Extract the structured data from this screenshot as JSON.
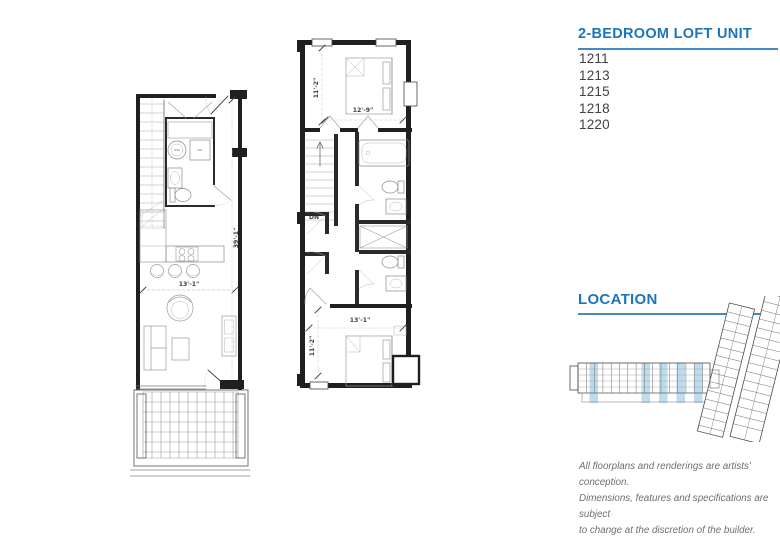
{
  "panel": {
    "title": "2-BEDROOM LOFT UNIT",
    "units": [
      "1211",
      "1213",
      "1215",
      "1218",
      "1220"
    ],
    "location_title": "LOCATION",
    "disclaimer_lines": [
      "All floorplans and renderings are artists' conception.",
      "Dimensions, features and specifications are subject",
      "to change at the discretion of the builder."
    ]
  },
  "floorplans": {
    "first_floor": {
      "dim_width": "13'-1\"",
      "dim_height": "39'-1\"",
      "washer_label": "WSH",
      "dryer_label": "DRY"
    },
    "second_floor": {
      "bedroom1_depth": "11'-2\"",
      "bedroom1_width": "12'-9\"",
      "bedroom2_width": "13'-1\"",
      "bedroom2_depth": "11'-2\"",
      "stairs_label": "DN"
    }
  },
  "colors": {
    "accent_blue": "#1C75BC",
    "underline_blue": "#4189C7",
    "highlight_blue": "#BFDCEE",
    "wall_black": "#1f1f1f",
    "text_dark": "#414042",
    "text_gray": "#6D6E71"
  }
}
